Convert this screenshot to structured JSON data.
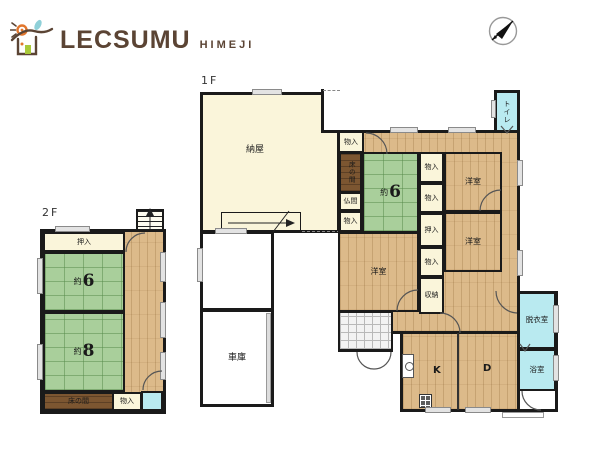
{
  "header": {
    "brand": "LECSUMU",
    "region": "HIMEJI"
  },
  "floor2": {
    "label": "2F",
    "oshiire": "押入",
    "tatami6": {
      "prefix": "約",
      "num": "6"
    },
    "tatami8": {
      "prefix": "約",
      "num": "8"
    },
    "tokonoma": "床の間",
    "monoire": "物入"
  },
  "floor1": {
    "label": "1F",
    "naya": "納屋",
    "garage": "車庫",
    "monoire_entry": "物入",
    "tokonoma": "床の間",
    "butsuma": "仏間",
    "monoire_west": "物入",
    "tatami6": {
      "prefix": "約",
      "num": "6"
    },
    "closet_1": "物入",
    "closet_2": "物入",
    "oshiire": "押入",
    "closet_3": "物入",
    "shunou": "収納",
    "western_1": "洋室",
    "western_2": "洋室",
    "western_3": "洋室",
    "toilet": "トイレ",
    "dressing": "脱衣室",
    "bath": "浴室",
    "kitchen": "K",
    "dining": "D"
  },
  "colors": {
    "brand": "#5b4434",
    "tatami": "#a9cf9b",
    "wood": "#dcba8a",
    "cream": "#faf5da",
    "water": "#b9eaf0",
    "tokonoma": "#7c5631",
    "wall": "#1a1a1a"
  }
}
